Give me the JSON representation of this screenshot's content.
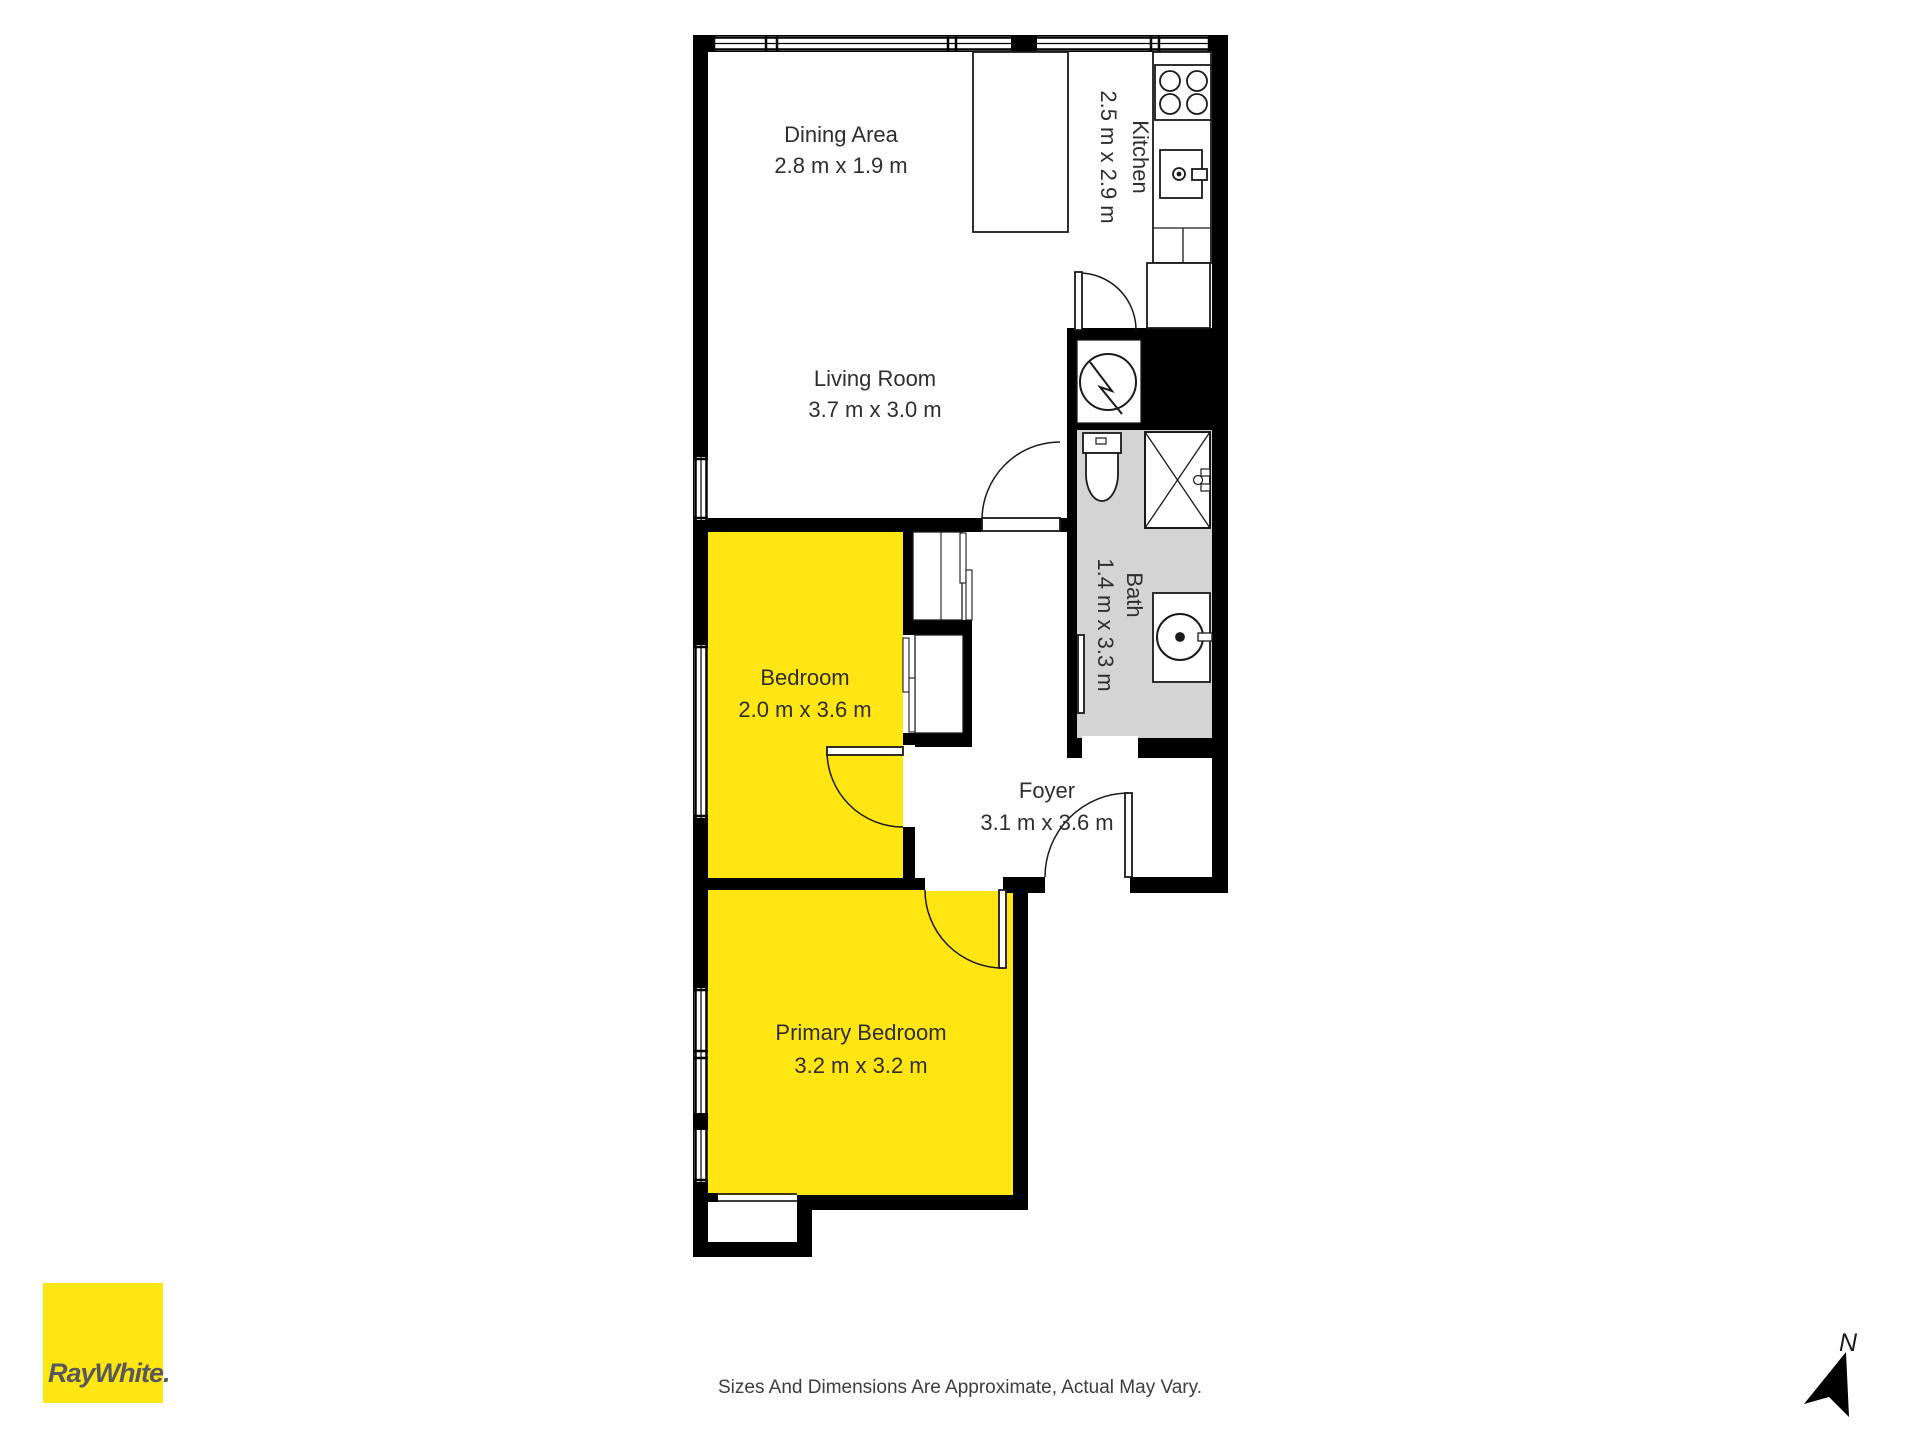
{
  "rooms": {
    "dining": {
      "name": "Dining Area",
      "dims": "2.8 m x 1.9 m"
    },
    "kitchen": {
      "name": "Kitchen",
      "dims": "2.5 m x 2.9 m"
    },
    "living": {
      "name": "Living Room",
      "dims": "3.7 m x 3.0 m"
    },
    "bath": {
      "name": "Bath",
      "dims": "1.4 m x 3.3 m"
    },
    "bedroom": {
      "name": "Bedroom",
      "dims": "2.0 m x 3.6 m"
    },
    "foyer": {
      "name": "Foyer",
      "dims": "3.1 m x 3.6 m"
    },
    "primary": {
      "name": "Primary Bedroom",
      "dims": "3.2 m x 3.2 m"
    }
  },
  "branding": {
    "logo_text": "RayWhite."
  },
  "compass": {
    "label": "N"
  },
  "footer": {
    "disclaimer": "Sizes And Dimensions Are Approximate, Actual May Vary."
  },
  "colors": {
    "room_highlight": "#ffe512",
    "bath_floor": "#d4d4d4",
    "wall": "#000000",
    "logo_text": "#58595b"
  }
}
